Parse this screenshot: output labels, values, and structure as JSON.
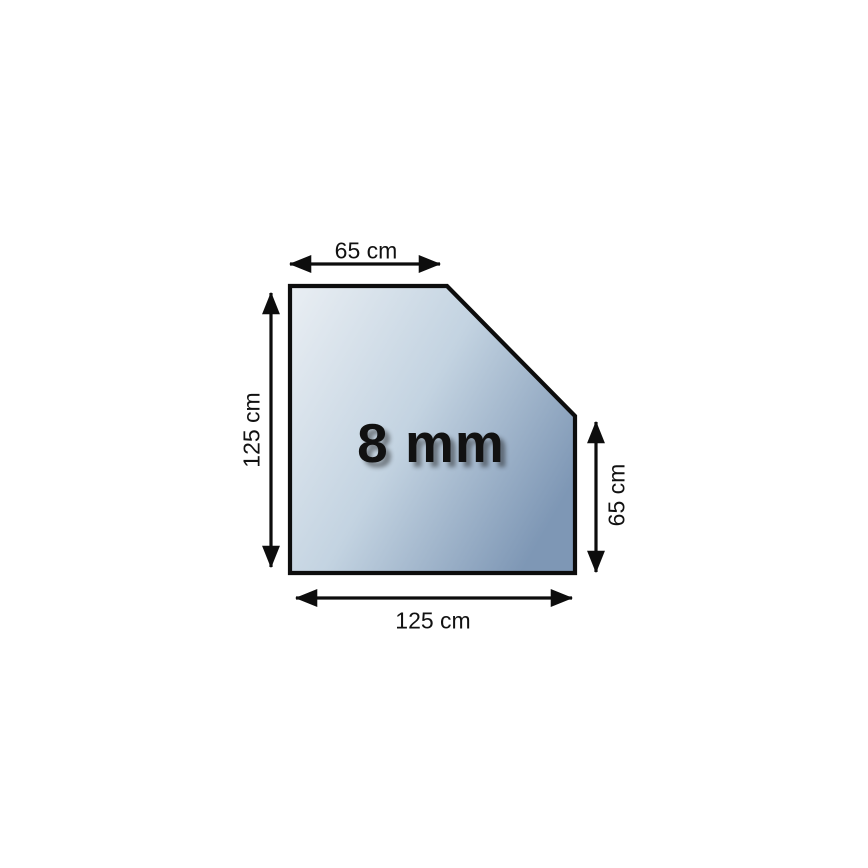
{
  "canvas": {
    "background": "#ffffff"
  },
  "colors": {
    "shape_gradient_start": "#e9eef3",
    "shape_gradient_mid": "#c3d3e1",
    "shape_gradient_end": "#7e97b5",
    "outline": "#0d0d0d",
    "text": "#111111"
  },
  "shape": {
    "type": "pentagon-panel-with-chamfered-corner",
    "thickness_label": "8 mm"
  },
  "dimensions": {
    "top": {
      "label": "65 cm"
    },
    "left": {
      "label": "125 cm"
    },
    "right": {
      "label": "65 cm"
    },
    "bottom": {
      "label": "125 cm"
    }
  }
}
